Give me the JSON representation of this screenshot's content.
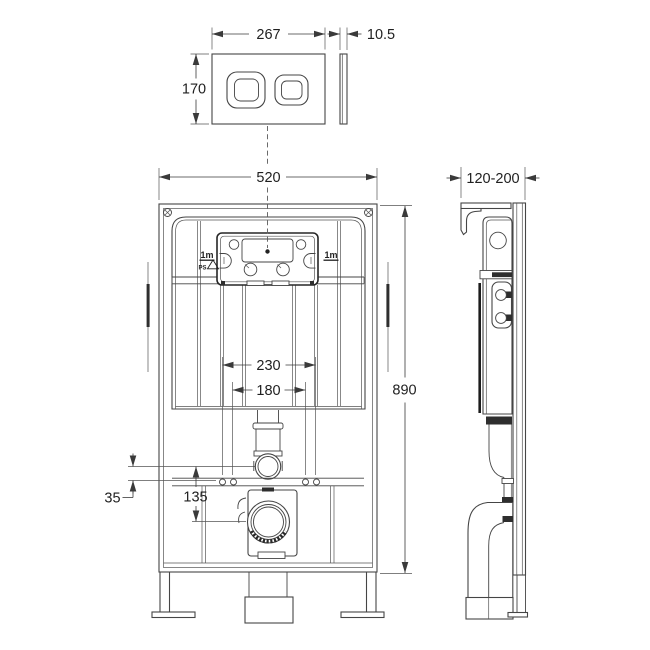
{
  "drawing": {
    "type": "concealed-cistern-frame-technical-drawing",
    "background": "#ffffff",
    "line_color": "#454545",
    "accent_color": "#2e2e2e",
    "dims": {
      "plate_width": "267",
      "plate_thickness": "10.5",
      "plate_height": "170",
      "frame_width": "520",
      "frame_height": "890",
      "depth_range": "120-200",
      "fixing_outer": "230",
      "fixing_inner": "180",
      "flush_offset": "35",
      "outlet_drop": "135"
    },
    "labels": {
      "hose_left": "1m",
      "hose_right": "1m",
      "material": "PS"
    }
  }
}
